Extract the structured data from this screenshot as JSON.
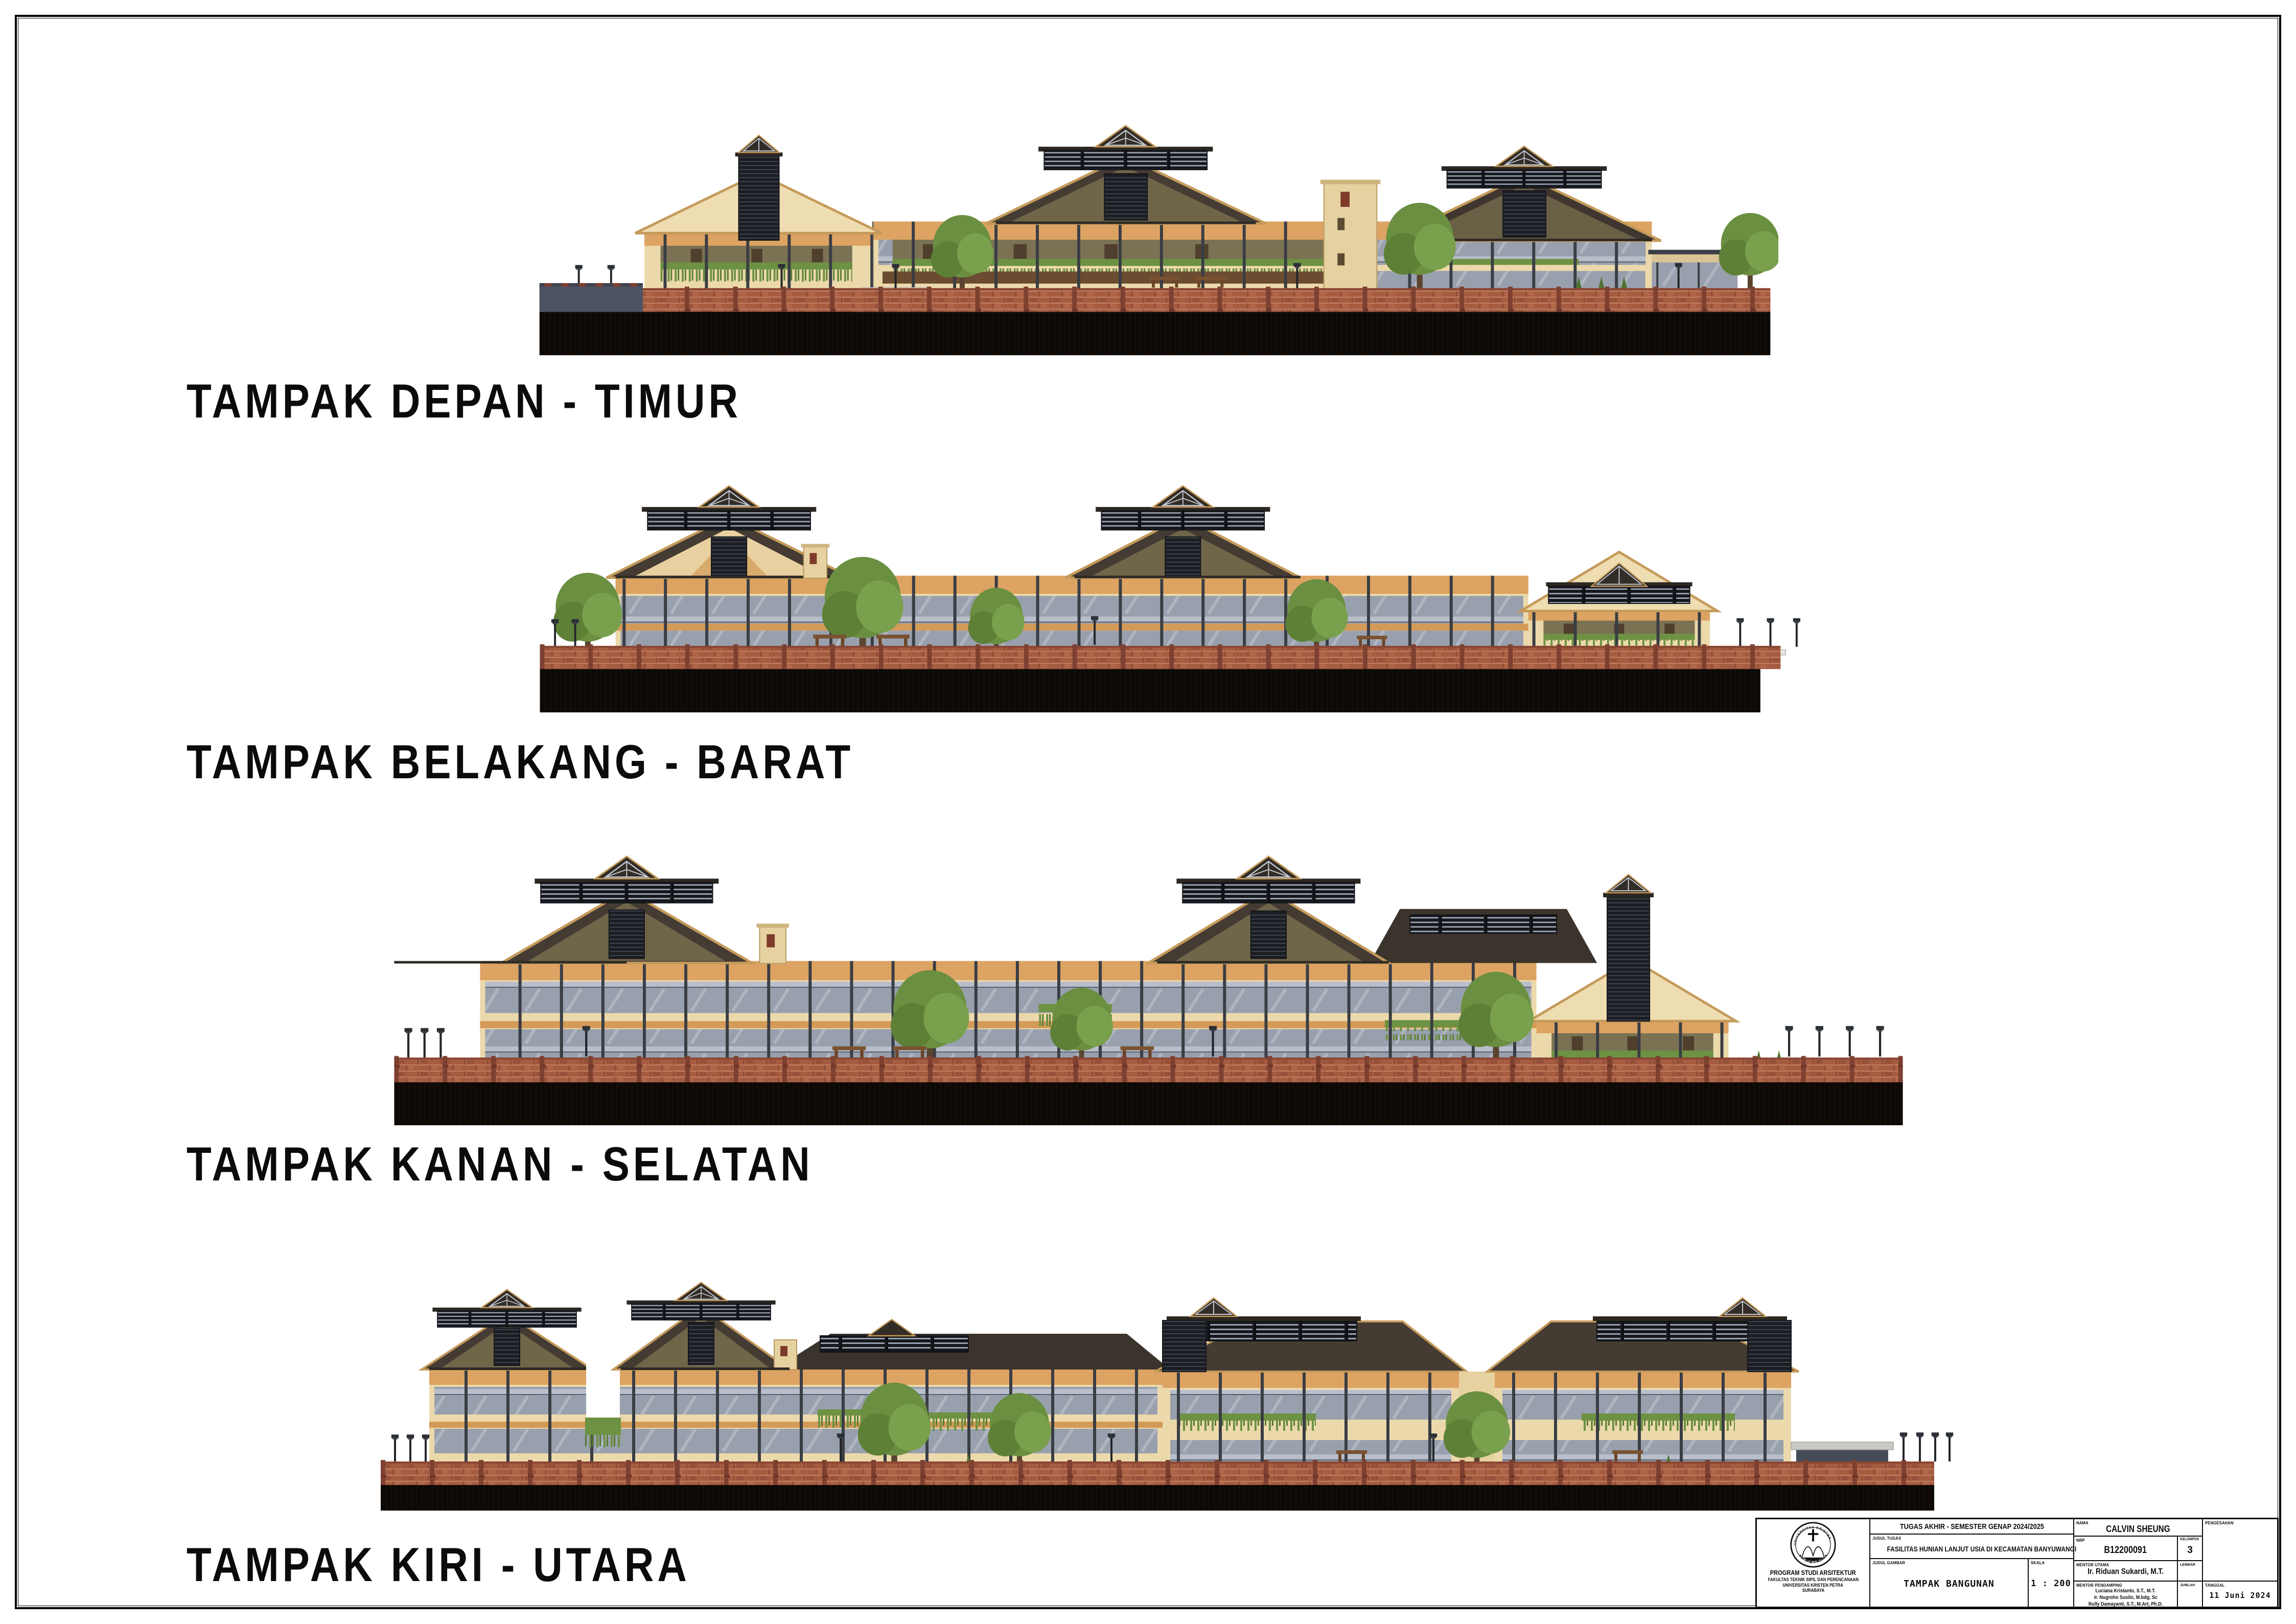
{
  "sheet": {
    "type": "architectural-elevation-sheet",
    "paper_color": "#ffffff"
  },
  "elevations": [
    {
      "id": "front-east",
      "label": "TAMPAK DEPAN - TIMUR"
    },
    {
      "id": "back-west",
      "label": "TAMPAK BELAKANG - BARAT"
    },
    {
      "id": "right-south",
      "label": "TAMPAK KANAN - SELATAN"
    },
    {
      "id": "left-north",
      "label": "TAMPAK KIRI - UTARA"
    }
  ],
  "title_block": {
    "project_header": "TUGAS AKHIR - SEMESTER GENAP 2024/2025",
    "labels": {
      "judul_tugas": "JUDUL TUGAS",
      "judul_gambar": "JUDUL GAMBAR",
      "skala": "SKALA",
      "nama": "NAMA",
      "nrp": "NRP",
      "kelompok": "KELOMPOK",
      "mentor_utama": "MENTOR UTAMA",
      "mentor_pendamping": "MENTOR PENDAMPING",
      "lembar": "LEMBAR",
      "jumlah": "JUMLAH",
      "pengesahan": "PENGESAHAN",
      "tanggal": "TANGGAL"
    },
    "values": {
      "judul_tugas": "FASILITAS HUNIAN LANJUT USIA DI KECAMATAN BANYUWANGI",
      "judul_gambar": "TAMPAK BANGUNAN",
      "skala": "1 : 200",
      "nama": "CALVIN SHEUNG",
      "nrp": "B12200091",
      "kelompok": "3",
      "mentor_utama": "Ir. Riduan Sukardi, M.T.",
      "mentor_pendamping_1": "Luciana Kristanto, S.T., M.T.",
      "mentor_pendamping_2": "Ir. Nugroho Susilo, M.bdg, Sc",
      "mentor_pendamping_3": "Rully Damayanti, S.T., M.Art, Ph.D.",
      "tanggal": "11 Juni 2024",
      "lembar": "",
      "jumlah": "",
      "pengesahan": ""
    },
    "institution": {
      "line1": "PROGRAM STUDI ARSITEKTUR",
      "line2": "FAKULTAS TEKNIK SIPIL DAN PERENCANAAN",
      "line3": "UNIVERSITAS KRISTEN PETRA",
      "line4": "SURABAYA",
      "logo_top": "UNIVERSITAS KRISTEN",
      "logo_bottom": "PETRA"
    }
  },
  "palette": {
    "roof_dark": "#443b33",
    "roof_fascia": "#c59a5a",
    "gable_olive": "#6f6549",
    "wall_cream": "#ecd9ab",
    "band_orange": "#dda362",
    "band_brown": "#6b4c31",
    "glass": "#99a0ad",
    "mullion": "#3a3d44",
    "greenery": "#6d9243",
    "brick_fence": "#a65c41",
    "ground": "#0d0906"
  }
}
